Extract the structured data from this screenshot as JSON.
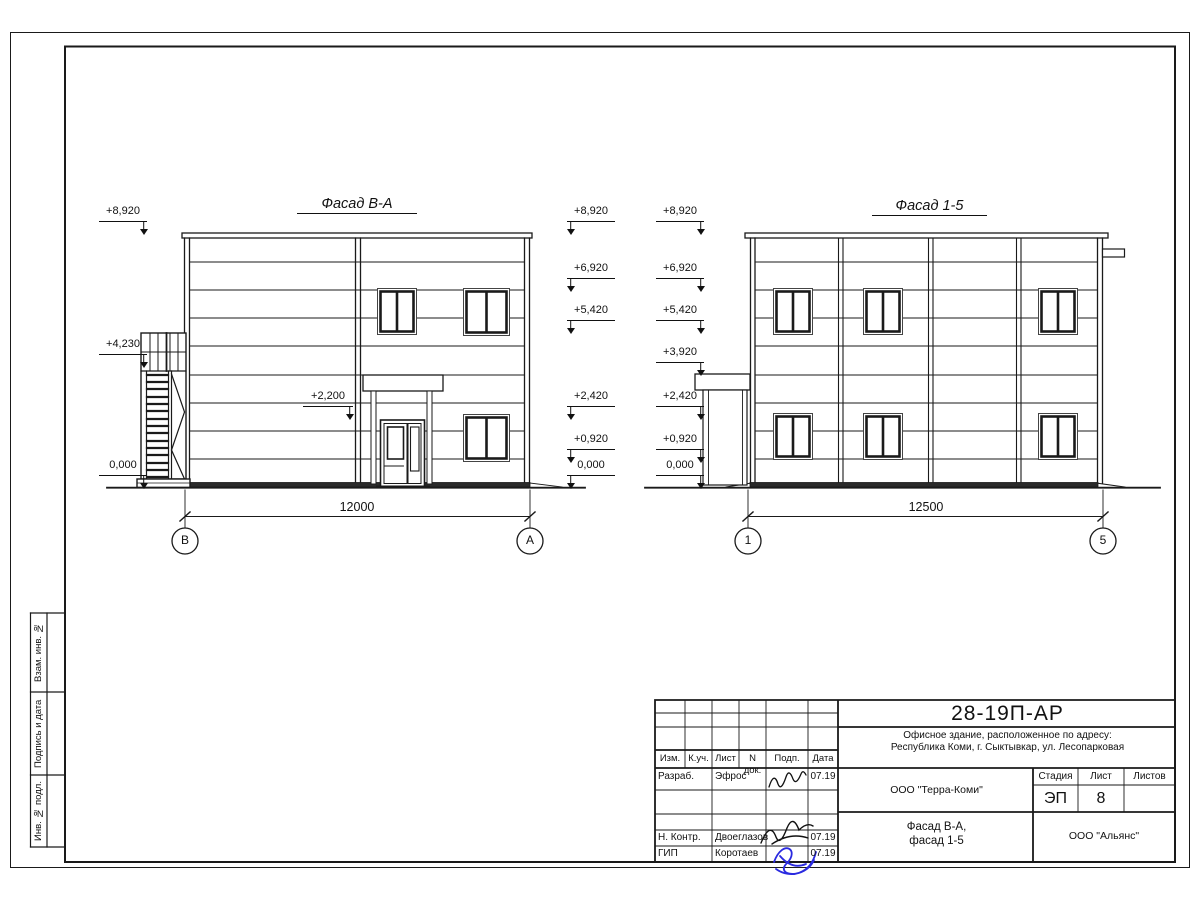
{
  "drawing": {
    "facade_left": {
      "title": "Фасад В-А",
      "dim": "12000",
      "axes": [
        "В",
        "А"
      ],
      "marks_left": [
        "+8,920",
        "+4,230",
        "0,000"
      ],
      "marks_right": [
        "+8,920",
        "+6,920",
        "+5,420",
        "+2,420",
        "+0,920",
        "0,000"
      ],
      "door_mark": "+2,200"
    },
    "facade_right": {
      "title": "Фасад 1-5",
      "dim": "12500",
      "axes": [
        "1",
        "5"
      ],
      "marks_left": [
        "+8,920",
        "+6,920",
        "+5,420",
        "+3,920",
        "+2,420",
        "+0,920",
        "0,000"
      ]
    }
  },
  "side_strip": {
    "labels": [
      "Взам. инв. №",
      "Подпись и дата",
      "Инв. № подл."
    ]
  },
  "title_block": {
    "doc_number": "28-19П-АР",
    "address_line1": "Офисное здание, расположенное по адресу:",
    "address_line2": "Республика Коми, г. Сыктывкар, ул. Лесопарковая",
    "client": "ООО \"Терра-Коми\"",
    "contractor": "ООО \"Альянс\"",
    "sheet_title_line1": "Фасад В-А,",
    "sheet_title_line2": "фасад 1-5",
    "stage_label": "Стадия",
    "sheet_label": "Лист",
    "sheets_label": "Листов",
    "stage_value": "ЭП",
    "sheet_value": "8",
    "sheets_value": "",
    "columns": [
      "Изм.",
      "К.уч.",
      "Лист",
      "N док.",
      "Подп.",
      "Дата"
    ],
    "rows": [
      {
        "role": "Разраб.",
        "name": "Эфрос",
        "date": "07.19"
      },
      {
        "role": "Н. Контр.",
        "name": "Двоеглазов",
        "date": "07.19"
      },
      {
        "role": "ГИП",
        "name": "Коротаев",
        "date": "07.19"
      }
    ]
  }
}
